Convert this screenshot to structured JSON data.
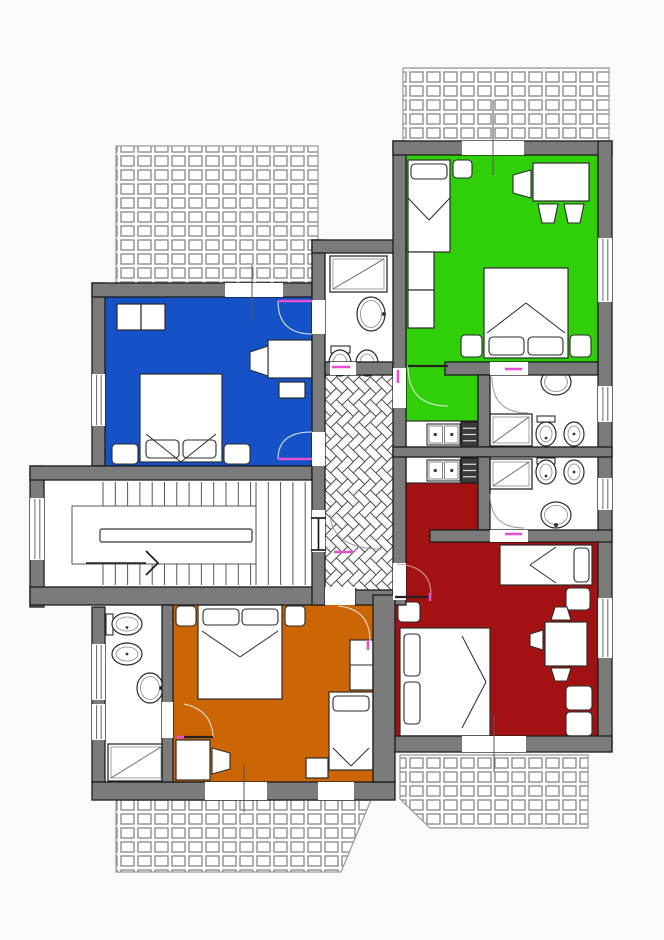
{
  "canvas": {
    "w": 664,
    "h": 940,
    "bg": "#fafafa"
  },
  "palette": {
    "wall": "#7b7b7b",
    "wall_stroke": "#1c1c1c",
    "floor": "#ffffff",
    "blue": "#1552c8",
    "green": "#2fd008",
    "red": "#a31212",
    "orange": "#cc6604",
    "door_pink": "#e54fd0",
    "furniture_stroke": "#2b2b2b",
    "tile_line": "#8f8f8f",
    "herringbone_line": "#4a4a4a",
    "stair_line": "#555555",
    "marker_line": "#555555"
  },
  "terraces": [
    {
      "n": "terrace-top-left",
      "pts": "116,146 318,146 318,286 116,286"
    },
    {
      "n": "terrace-top-right",
      "pts": "403,68 609,68 609,155 403,155"
    },
    {
      "n": "terrace-bottom-left",
      "pts": "116,800 371,800 341,872 116,872"
    },
    {
      "n": "terrace-bottom-right",
      "pts": "400,755 588,755 588,828 430,828 400,799"
    }
  ],
  "base": [
    [
      92,
      283,
      233,
      517
    ],
    [
      312,
      253,
      94,
      352
    ],
    [
      30,
      466,
      62,
      141
    ],
    [
      393,
      155,
      219,
      597
    ]
  ],
  "rooms": [
    {
      "n": "room-blue-bedroom",
      "color": "#1552c8",
      "rects": [
        [
          105,
          297,
          207,
          169
        ]
      ]
    },
    {
      "n": "room-green-apartment",
      "color": "#2fd008",
      "rects": [
        [
          406,
          155,
          192,
          207
        ],
        [
          406,
          362,
          72,
          59
        ]
      ]
    },
    {
      "n": "room-red-apartment",
      "color": "#a31212",
      "rects": [
        [
          406,
          483,
          72,
          59
        ],
        [
          395,
          542,
          203,
          194
        ]
      ]
    },
    {
      "n": "room-orange-bedroom",
      "color": "#cc6604",
      "rects": [
        [
          173,
          605,
          200,
          177
        ]
      ]
    }
  ],
  "hallway": {
    "n": "hallway-herringbone",
    "rect": [
      325,
      375,
      68,
      230
    ],
    "u": 8
  },
  "stairs": {
    "n": "staircase",
    "outline": [
      72,
      506,
      184,
      58
    ],
    "rail": [
      100,
      529,
      152,
      13
    ],
    "bands": [
      {
        "x0": 103,
        "x1": 251,
        "step": 12.3,
        "y0": 482,
        "y1": 506
      },
      {
        "x0": 103,
        "x1": 251,
        "step": 12.3,
        "y0": 564,
        "y1": 585
      },
      {
        "x0": 256,
        "x1": 311,
        "step": 12.3,
        "y0": 482,
        "y1": 585
      }
    ],
    "arrow_line": [
      86,
      563,
      146,
      563
    ],
    "arrow_head": "146,551 158,563 146,575"
  },
  "furniture": [
    {
      "n": "nightstand",
      "t": "rect",
      "r": [
        117,
        304,
        24,
        26
      ]
    },
    {
      "n": "nightstand",
      "t": "rect",
      "r": [
        141,
        304,
        24,
        26
      ]
    },
    {
      "n": "desk",
      "t": "rect",
      "r": [
        268,
        340,
        44,
        38
      ]
    },
    {
      "n": "desk-return",
      "t": "rect",
      "r": [
        279,
        382,
        26,
        16
      ]
    },
    {
      "n": "chair",
      "t": "poly",
      "p": "268,346 250,352 250,370 268,376"
    },
    {
      "n": "double-bed",
      "t": "rect",
      "r": [
        140,
        374,
        82,
        88
      ]
    },
    {
      "n": "pillow",
      "t": "pillow",
      "r": [
        146,
        440,
        33,
        18
      ]
    },
    {
      "n": "pillow",
      "t": "pillow",
      "r": [
        183,
        440,
        33,
        18
      ]
    },
    {
      "n": "duvet-fold",
      "t": "line",
      "p": [
        146,
        434,
        181,
        462
      ]
    },
    {
      "n": "duvet-fold",
      "t": "line",
      "p": [
        216,
        434,
        181,
        462
      ]
    },
    {
      "n": "side-table",
      "t": "pillow",
      "r": [
        112,
        444,
        26,
        20
      ]
    },
    {
      "n": "side-table",
      "t": "pillow",
      "r": [
        224,
        444,
        26,
        20
      ]
    },
    {
      "n": "single-bed",
      "t": "rect",
      "r": [
        408,
        160,
        42,
        92
      ]
    },
    {
      "n": "pillow",
      "t": "pillow",
      "r": [
        411,
        164,
        36,
        15
      ]
    },
    {
      "n": "duvet-fold",
      "t": "line",
      "p": [
        408,
        198,
        429,
        220
      ]
    },
    {
      "n": "duvet-fold",
      "t": "line",
      "p": [
        450,
        198,
        429,
        220
      ]
    },
    {
      "n": "nightstand",
      "t": "pillow",
      "r": [
        453,
        160,
        19,
        18
      ]
    },
    {
      "n": "table",
      "t": "rect",
      "r": [
        533,
        163,
        56,
        38
      ]
    },
    {
      "n": "chair",
      "t": "poly",
      "p": "531,170 513,175 513,193 531,198"
    },
    {
      "n": "chair",
      "t": "poly",
      "p": "538,204 558,204 554,223 542,223"
    },
    {
      "n": "chair",
      "t": "poly",
      "p": "564,204 584,204 580,223 568,223"
    },
    {
      "n": "wardrobe",
      "t": "rect",
      "r": [
        408,
        252,
        26,
        38
      ]
    },
    {
      "n": "wardrobe",
      "t": "rect",
      "r": [
        408,
        290,
        26,
        38
      ]
    },
    {
      "n": "double-bed",
      "t": "rect",
      "r": [
        484,
        268,
        84,
        90
      ]
    },
    {
      "n": "pillow",
      "t": "pillow",
      "r": [
        489,
        337,
        35,
        18
      ]
    },
    {
      "n": "pillow",
      "t": "pillow",
      "r": [
        528,
        337,
        35,
        18
      ]
    },
    {
      "n": "duvet-fold",
      "t": "line",
      "p": [
        487,
        333,
        526,
        303
      ]
    },
    {
      "n": "duvet-fold",
      "t": "line",
      "p": [
        565,
        333,
        526,
        303
      ]
    },
    {
      "n": "side-table",
      "t": "pillow",
      "r": [
        461,
        335,
        21,
        22
      ]
    },
    {
      "n": "side-table",
      "t": "pillow",
      "r": [
        570,
        335,
        21,
        22
      ]
    },
    {
      "n": "kitchen-counter",
      "t": "rect",
      "r": [
        406,
        421,
        72,
        26
      ]
    },
    {
      "n": "kitchen-sink",
      "t": "sink2",
      "r": [
        427,
        424,
        33,
        21
      ]
    },
    {
      "n": "stove",
      "t": "stove",
      "r": [
        461,
        422,
        17,
        25
      ]
    },
    {
      "n": "kitchen-counter",
      "t": "rect",
      "r": [
        406,
        457,
        72,
        26
      ]
    },
    {
      "n": "kitchen-sink",
      "t": "sink2",
      "r": [
        427,
        460,
        33,
        21
      ]
    },
    {
      "n": "stove",
      "t": "stove",
      "r": [
        461,
        458,
        17,
        25
      ]
    },
    {
      "n": "single-bed",
      "t": "rect",
      "r": [
        500,
        545,
        92,
        40
      ]
    },
    {
      "n": "pillow",
      "t": "pillow",
      "r": [
        574,
        548,
        15,
        34
      ]
    },
    {
      "n": "duvet-fold",
      "t": "line",
      "p": [
        556,
        547,
        530,
        565
      ]
    },
    {
      "n": "duvet-fold",
      "t": "line",
      "p": [
        556,
        583,
        530,
        565
      ]
    },
    {
      "n": "side-table",
      "t": "pillow",
      "r": [
        566,
        588,
        24,
        22
      ]
    },
    {
      "n": "table",
      "t": "rect",
      "r": [
        545,
        622,
        42,
        44
      ]
    },
    {
      "n": "chair",
      "t": "poly",
      "p": "551,620 571,620 567,607 555,607"
    },
    {
      "n": "chair",
      "t": "poly",
      "p": "551,668 571,668 567,681 555,681"
    },
    {
      "n": "chair",
      "t": "poly",
      "p": "543,630 543,650 530,646 530,634"
    },
    {
      "n": "bench",
      "t": "pillow",
      "r": [
        566,
        686,
        26,
        24
      ]
    },
    {
      "n": "bench",
      "t": "pillow",
      "r": [
        566,
        712,
        26,
        24
      ]
    },
    {
      "n": "double-bed",
      "t": "rect",
      "r": [
        400,
        628,
        90,
        108
      ]
    },
    {
      "n": "pillow",
      "t": "pillow",
      "r": [
        404,
        634,
        16,
        42
      ]
    },
    {
      "n": "pillow",
      "t": "pillow",
      "r": [
        404,
        682,
        16,
        42
      ]
    },
    {
      "n": "duvet-fold",
      "t": "line",
      "p": [
        462,
        636,
        486,
        682
      ]
    },
    {
      "n": "duvet-fold",
      "t": "line",
      "p": [
        462,
        728,
        486,
        682
      ]
    },
    {
      "n": "nightstand",
      "t": "pillow",
      "r": [
        398,
        602,
        22,
        20
      ]
    },
    {
      "n": "nightstand",
      "t": "pillow",
      "r": [
        176,
        606,
        20,
        20
      ]
    },
    {
      "n": "double-bed",
      "t": "rect",
      "r": [
        198,
        605,
        84,
        94
      ]
    },
    {
      "n": "pillow",
      "t": "pillow",
      "r": [
        203,
        609,
        36,
        16
      ]
    },
    {
      "n": "pillow",
      "t": "pillow",
      "r": [
        242,
        609,
        36,
        16
      ]
    },
    {
      "n": "duvet-fold",
      "t": "line",
      "p": [
        202,
        631,
        240,
        657
      ]
    },
    {
      "n": "duvet-fold",
      "t": "line",
      "p": [
        278,
        631,
        240,
        657
      ]
    },
    {
      "n": "nightstand",
      "t": "pillow",
      "r": [
        285,
        606,
        20,
        20
      ]
    },
    {
      "n": "wardrobe",
      "t": "rect",
      "r": [
        350,
        640,
        23,
        50
      ]
    },
    {
      "n": "wardrobe-divider",
      "t": "line",
      "p": [
        350,
        665,
        373,
        665
      ]
    },
    {
      "n": "single-bed",
      "t": "rect",
      "r": [
        329,
        692,
        44,
        78
      ]
    },
    {
      "n": "pillow",
      "t": "pillow",
      "r": [
        333,
        696,
        36,
        15
      ]
    },
    {
      "n": "duvet-fold",
      "t": "line",
      "p": [
        333,
        748,
        351,
        766
      ]
    },
    {
      "n": "duvet-fold",
      "t": "line",
      "p": [
        369,
        748,
        351,
        766
      ]
    },
    {
      "n": "stool",
      "t": "rect",
      "r": [
        306,
        758,
        22,
        20
      ]
    },
    {
      "n": "desk",
      "t": "rect",
      "r": [
        176,
        740,
        34,
        40
      ]
    },
    {
      "n": "chair",
      "t": "poly",
      "p": "212,748 230,753 230,769 212,774"
    },
    {
      "n": "shower",
      "t": "shower",
      "r": [
        330,
        256,
        57,
        36
      ]
    },
    {
      "n": "sink",
      "t": "sink",
      "e": [
        371,
        314,
        14,
        17
      ],
      "dot": [
        384,
        314
      ]
    },
    {
      "n": "toilet",
      "t": "toilet",
      "e": [
        340,
        363,
        11,
        13
      ],
      "tank": [
        331,
        346,
        19,
        7
      ]
    },
    {
      "n": "bidet",
      "t": "bidet",
      "e": [
        367,
        363,
        11,
        13
      ]
    },
    {
      "n": "sink",
      "t": "sink",
      "e": [
        556,
        382,
        15,
        13
      ],
      "dot": [
        556,
        372
      ]
    },
    {
      "n": "shower",
      "t": "shower",
      "r": [
        490,
        414,
        42,
        32
      ]
    },
    {
      "n": "toilet",
      "t": "toilet",
      "e": [
        546,
        434,
        10,
        12
      ],
      "tank": [
        537,
        416,
        18,
        6
      ]
    },
    {
      "n": "bidet",
      "t": "bidet",
      "e": [
        574,
        434,
        10,
        12
      ]
    },
    {
      "n": "shower",
      "t": "shower",
      "r": [
        490,
        459,
        42,
        30
      ]
    },
    {
      "n": "toilet",
      "t": "toilet",
      "e": [
        546,
        472,
        10,
        12
      ],
      "tank": [
        537,
        458,
        18,
        6
      ]
    },
    {
      "n": "bidet",
      "t": "bidet",
      "e": [
        574,
        472,
        10,
        12
      ]
    },
    {
      "n": "sink",
      "t": "sink",
      "e": [
        556,
        515,
        15,
        13
      ],
      "dot": [
        556,
        525
      ]
    },
    {
      "n": "toilet",
      "t": "toilet",
      "e": [
        127,
        624,
        15,
        11
      ],
      "tank": [
        106,
        614,
        7,
        21
      ]
    },
    {
      "n": "bidet",
      "t": "bidet",
      "e": [
        127,
        654,
        15,
        11
      ]
    },
    {
      "n": "sink",
      "t": "sink",
      "e": [
        150,
        688,
        13,
        15
      ],
      "dot": [
        161,
        688
      ]
    },
    {
      "n": "shower",
      "t": "shower",
      "r": [
        108,
        744,
        56,
        37
      ]
    }
  ],
  "walls": [
    [
      92,
      283,
      13,
      183
    ],
    [
      92,
      607,
      13,
      175
    ],
    [
      30,
      466,
      14,
      141
    ],
    [
      30,
      466,
      282,
      14
    ],
    [
      30,
      587,
      295,
      18
    ],
    [
      355,
      590,
      38,
      15
    ],
    [
      92,
      283,
      220,
      14
    ],
    [
      312,
      240,
      13,
      365
    ],
    [
      312,
      240,
      94,
      13
    ],
    [
      325,
      362,
      68,
      13
    ],
    [
      393,
      141,
      13,
      464
    ],
    [
      393,
      141,
      219,
      14
    ],
    [
      598,
      141,
      14,
      609
    ],
    [
      445,
      362,
      153,
      13
    ],
    [
      478,
      375,
      12,
      72
    ],
    [
      393,
      447,
      219,
      10
    ],
    [
      478,
      457,
      12,
      73
    ],
    [
      430,
      530,
      182,
      12
    ],
    [
      393,
      736,
      219,
      16
    ],
    [
      92,
      782,
      303,
      18
    ],
    [
      373,
      595,
      22,
      187
    ],
    [
      162,
      605,
      11,
      177
    ]
  ],
  "gaps": [
    [
      225,
      283,
      58,
      14
    ],
    [
      462,
      141,
      62,
      14
    ],
    [
      205,
      782,
      62,
      18
    ],
    [
      318,
      782,
      36,
      18
    ],
    [
      462,
      736,
      64,
      16
    ],
    [
      312,
      300,
      13,
      34
    ],
    [
      312,
      432,
      13,
      34
    ],
    [
      312,
      510,
      13,
      42
    ],
    [
      393,
      368,
      13,
      40
    ],
    [
      393,
      563,
      13,
      37
    ],
    [
      490,
      362,
      38,
      13
    ],
    [
      490,
      530,
      38,
      12
    ],
    [
      330,
      362,
      26,
      13
    ],
    [
      162,
      702,
      11,
      36
    ],
    [
      325,
      587,
      30,
      18
    ]
  ],
  "windows": [
    {
      "n": "window",
      "r": [
        92,
        374,
        13,
        52
      ]
    },
    {
      "n": "window",
      "r": [
        30,
        498,
        14,
        62
      ]
    },
    {
      "n": "window",
      "r": [
        92,
        644,
        13,
        56
      ]
    },
    {
      "n": "window",
      "r": [
        92,
        704,
        13,
        36
      ]
    },
    {
      "n": "window",
      "r": [
        598,
        238,
        14,
        64
      ]
    },
    {
      "n": "window",
      "r": [
        598,
        386,
        14,
        36
      ]
    },
    {
      "n": "window",
      "r": [
        598,
        478,
        14,
        32
      ]
    },
    {
      "n": "window",
      "r": [
        598,
        598,
        14,
        60
      ]
    }
  ],
  "doors": [
    {
      "n": "door-blue-north",
      "arc": "M278,301 Q278,334 312,334",
      "tick": [
        278,
        301,
        312,
        301
      ],
      "ac": "#e9e9e9"
    },
    {
      "n": "door-blue-south",
      "arc": "M312,432 Q278,432 278,459",
      "tick": [
        278,
        459,
        312,
        459
      ],
      "ac": "#e9e9e9"
    },
    {
      "n": "door-green-entry",
      "arc": "M408,366 Q408,406 448,406",
      "leaf": [
        408,
        366,
        448,
        366
      ],
      "tick": [
        398,
        370,
        398,
        383
      ],
      "ac": "#e9e9e9"
    },
    {
      "n": "door-green-bath",
      "arc": "M492,377 Q492,413 528,413",
      "tick": [
        505,
        369,
        522,
        369
      ],
      "ac": "#999999"
    },
    {
      "n": "door-red-bath",
      "arc": "M490,494 Q490,528 524,528",
      "tick": [
        505,
        534,
        522,
        534
      ],
      "ac": "#999999"
    },
    {
      "n": "door-stairs-hall",
      "arc": "M330,514 Q332,549 382,549",
      "tick": [
        334,
        552,
        354,
        552
      ],
      "lines": [
        [
          311,
          518,
          326,
          518
        ],
        [
          311,
          550,
          326,
          550
        ],
        [
          318.5,
          518,
          318.5,
          550
        ]
      ],
      "ac": "#999999"
    },
    {
      "n": "door-red-entry",
      "arc": "M431,595 Q431,566 397,564",
      "leaf": [
        395,
        597,
        431,
        597
      ],
      "tick": [
        430,
        593,
        430,
        601
      ],
      "ac": "#d9a0a0"
    },
    {
      "n": "door-orange-entry",
      "arc": "M338,606 Q370,609 370,641",
      "tick": [
        368,
        640,
        368,
        650
      ],
      "ac": "#e9e9e9"
    },
    {
      "n": "door-orange-bath",
      "arc": "M213,737 Q212,710 184,704",
      "leaf": [
        183,
        737,
        213,
        737
      ],
      "tick": [
        177,
        737,
        184,
        737
      ],
      "ac": "#e9e9e9"
    },
    {
      "n": "door-blue-bath",
      "tick": [
        332,
        367,
        350,
        367
      ]
    }
  ],
  "markers": [
    {
      "n": "french-door-line-blue",
      "p": [
        252,
        265,
        252,
        322
      ]
    },
    {
      "n": "french-door-line-green",
      "p": [
        493,
        100,
        493,
        175
      ]
    },
    {
      "n": "french-door-line-orange",
      "p": [
        244,
        765,
        244,
        812
      ]
    },
    {
      "n": "french-door-line-red",
      "p": [
        494,
        715,
        494,
        772
      ]
    }
  ]
}
